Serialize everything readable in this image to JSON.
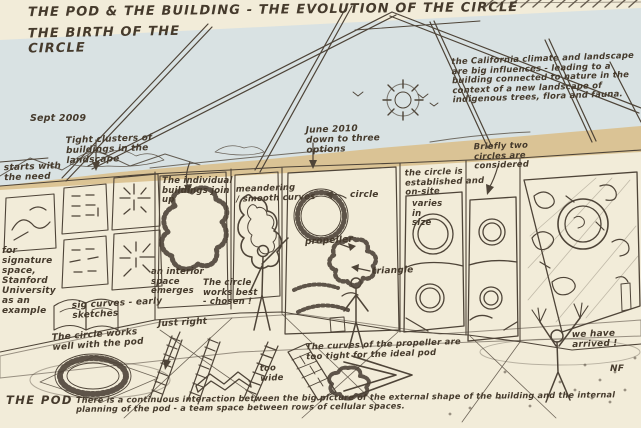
{
  "title": {
    "line1": "THE POD & THE BUILDING - THE EVOLUTION OF THE CIRCLE",
    "line2": "THE BIRTH OF THE\nCIRCLE"
  },
  "notes": {
    "california": "the California climate and landscape are big influences - leading to a building connected to nature in the context of a new landscape of indigenous trees, flora and fauna.",
    "sept2009": "Sept 2009",
    "clusters": "Tight clusters of\nbuildings in the\nlandscape",
    "starts": "starts with\nthe need",
    "signature_space": "for signature\nspace,\nStanford\nUniversity\nas an\nexample",
    "sig_curves": "sig curves - early\nsketches",
    "individual": "The individual\nbuildings join\nup",
    "interior": "an interior\nspace\nemerges",
    "meandering": "meandering\n/ smooth curves",
    "circle_best": "The circle\nworks best\n- chosen !",
    "june2010": "June 2010\ndown to three\noptions",
    "label_circle": "circle",
    "label_propeller": "propeller",
    "label_triangle": "triangle",
    "established": "the circle is\nestablished and\non-site",
    "varies": "varies\nin\nsize",
    "briefly": "Briefly two\ncircles are\nconsidered",
    "circle_works": "The circle works\nwell with the pod",
    "just_right": "Just right",
    "curves_propeller": "The curves of the propeller are\ntoo tight for the ideal pod",
    "too_wide": "too\nwide",
    "arrived": "we have\narrived !",
    "initials": "NF",
    "the_pod": "THE POD",
    "bottom_summary": "There is a continuous interaction between the big picture of the external shape of the building and the internal planning of the pod - a team space between rows of cellular spaces."
  },
  "colors": {
    "paper": "#f2ecd9",
    "ink": "#4e4438",
    "sky": "#d5e0e4",
    "hills": "#d9c08c",
    "sun": "#f0d43e",
    "site_green": "#abc87c",
    "accent_red": "#b35a40"
  }
}
